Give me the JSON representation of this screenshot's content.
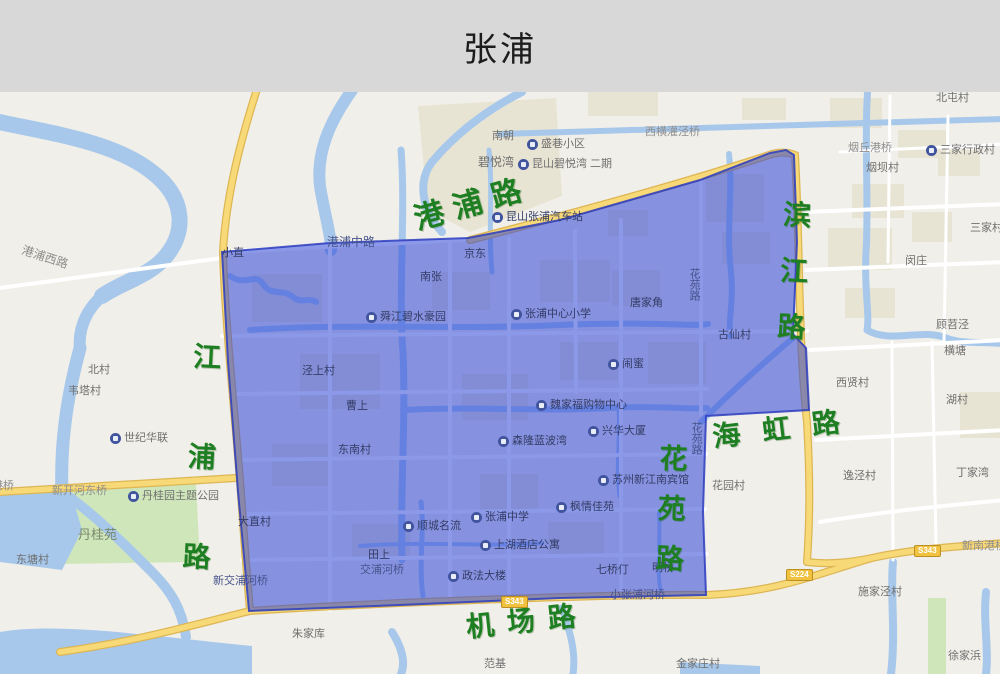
{
  "header": {
    "title": "张浦"
  },
  "map": {
    "green_roads": [
      {
        "text": "港浦路",
        "x": 408,
        "y": 104,
        "rot": -16,
        "size": 30,
        "ls": 10,
        "vertical": false
      },
      {
        "text": "滨江路",
        "x": 776,
        "y": 107,
        "rot": 3,
        "size": 28,
        "ls": 28,
        "vertical": true
      },
      {
        "text": "江浦路",
        "x": 186,
        "y": 249,
        "rot": 3,
        "size": 28,
        "ls": 72,
        "vertical": true
      },
      {
        "text": "海虹路",
        "x": 710,
        "y": 324,
        "rot": -7,
        "size": 28,
        "ls": 22,
        "vertical": false
      },
      {
        "text": "花苑路",
        "x": 652,
        "y": 351,
        "rot": 2,
        "size": 28,
        "ls": 22,
        "vertical": true
      },
      {
        "text": "机场路",
        "x": 464,
        "y": 514,
        "rot": -6,
        "size": 28,
        "ls": 13,
        "vertical": false
      }
    ],
    "shields": [
      {
        "text": "S343",
        "x": 501,
        "y": 504
      },
      {
        "text": "S224",
        "x": 786,
        "y": 477
      },
      {
        "text": "S343",
        "x": 914,
        "y": 453
      }
    ],
    "labels": [
      {
        "text": "港浦西路",
        "x": 24,
        "y": 152,
        "tone": "road",
        "rot": 18,
        "size": 12
      },
      {
        "text": "南朝",
        "x": 492,
        "y": 38,
        "tone": "out"
      },
      {
        "text": "盛巷小区",
        "x": 527,
        "y": 46,
        "tone": "out",
        "icon": true
      },
      {
        "text": "碧悦湾",
        "x": 478,
        "y": 64,
        "tone": "out",
        "size": 12
      },
      {
        "text": "昆山碧悦湾 二期",
        "x": 518,
        "y": 66,
        "tone": "out",
        "icon": true
      },
      {
        "text": "西横灌泾桥",
        "x": 645,
        "y": 34,
        "tone": "road"
      },
      {
        "text": "北屯村",
        "x": 936,
        "y": 0,
        "tone": "out"
      },
      {
        "text": "烟丘港桥",
        "x": 848,
        "y": 50,
        "tone": "road"
      },
      {
        "text": "烟坝村",
        "x": 866,
        "y": 70,
        "tone": "out"
      },
      {
        "text": "三家行政村",
        "x": 926,
        "y": 52,
        "tone": "out",
        "icon": true
      },
      {
        "text": "三家村",
        "x": 970,
        "y": 130,
        "tone": "out"
      },
      {
        "text": "闵庄",
        "x": 905,
        "y": 163,
        "tone": "out"
      },
      {
        "text": "顾苕泾",
        "x": 936,
        "y": 227,
        "tone": "out"
      },
      {
        "text": "横塘",
        "x": 944,
        "y": 253,
        "tone": "out"
      },
      {
        "text": "西贤村",
        "x": 836,
        "y": 285,
        "tone": "out"
      },
      {
        "text": "湖村",
        "x": 946,
        "y": 302,
        "tone": "out"
      },
      {
        "text": "逸泾村",
        "x": 843,
        "y": 378,
        "tone": "out"
      },
      {
        "text": "丁家湾",
        "x": 956,
        "y": 375,
        "tone": "out"
      },
      {
        "text": "新南港桥",
        "x": 962,
        "y": 448,
        "tone": "road"
      },
      {
        "text": "施家泾村",
        "x": 858,
        "y": 494,
        "tone": "out"
      },
      {
        "text": "徐家浜",
        "x": 948,
        "y": 558,
        "tone": "out"
      },
      {
        "text": "金家庄村",
        "x": 676,
        "y": 566,
        "tone": "out"
      },
      {
        "text": "范基",
        "x": 484,
        "y": 566,
        "tone": "out"
      },
      {
        "text": "朱家库",
        "x": 292,
        "y": 536,
        "tone": "out"
      },
      {
        "text": "北村",
        "x": 88,
        "y": 272,
        "tone": "out"
      },
      {
        "text": "韦塔村",
        "x": 68,
        "y": 293,
        "tone": "out"
      },
      {
        "text": "世纪华联",
        "x": 110,
        "y": 340,
        "tone": "out",
        "icon": true
      },
      {
        "text": "港桥",
        "x": -8,
        "y": 388,
        "tone": "road"
      },
      {
        "text": "新开河东桥",
        "x": 52,
        "y": 393,
        "tone": "road"
      },
      {
        "text": "丹桂园主题公园",
        "x": 128,
        "y": 398,
        "tone": "out",
        "icon": true
      },
      {
        "text": "丹桂苑",
        "x": 78,
        "y": 436,
        "tone": "park",
        "size": 13
      },
      {
        "text": "东塘村",
        "x": 16,
        "y": 462,
        "tone": "out"
      },
      {
        "text": "小直",
        "x": 222,
        "y": 155,
        "tone": "in"
      },
      {
        "text": "港浦中路",
        "x": 327,
        "y": 144,
        "tone": "roadin",
        "size": 12
      },
      {
        "text": "昆山张浦汽车站",
        "x": 492,
        "y": 119,
        "tone": "in",
        "icon": true
      },
      {
        "text": "京东",
        "x": 464,
        "y": 156,
        "tone": "in"
      },
      {
        "text": "南张",
        "x": 420,
        "y": 179,
        "tone": "in"
      },
      {
        "text": "舜江碧水豪园",
        "x": 366,
        "y": 219,
        "tone": "in",
        "icon": true
      },
      {
        "text": "张浦中心小学",
        "x": 511,
        "y": 216,
        "tone": "in",
        "icon": true
      },
      {
        "text": "唐家角",
        "x": 630,
        "y": 205,
        "tone": "in"
      },
      {
        "text": "花苑路",
        "x": 688,
        "y": 176,
        "tone": "roadin",
        "vertical": true
      },
      {
        "text": "古仙村",
        "x": 718,
        "y": 237,
        "tone": "in"
      },
      {
        "text": "闹蜜",
        "x": 608,
        "y": 266,
        "tone": "in",
        "icon": true
      },
      {
        "text": "泾上村",
        "x": 302,
        "y": 273,
        "tone": "in"
      },
      {
        "text": "曹上",
        "x": 346,
        "y": 308,
        "tone": "in"
      },
      {
        "text": "魏家福购物中心",
        "x": 536,
        "y": 307,
        "tone": "in",
        "icon": true
      },
      {
        "text": "兴华大厦",
        "x": 588,
        "y": 333,
        "tone": "in",
        "icon": true
      },
      {
        "text": "东南村",
        "x": 338,
        "y": 352,
        "tone": "in"
      },
      {
        "text": "森隆蓝波湾",
        "x": 498,
        "y": 343,
        "tone": "in",
        "icon": true
      },
      {
        "text": "花苑路",
        "x": 690,
        "y": 330,
        "tone": "roadin",
        "vertical": true
      },
      {
        "text": "苏州新江南宾馆",
        "x": 598,
        "y": 382,
        "tone": "in",
        "icon": true
      },
      {
        "text": "花园村",
        "x": 712,
        "y": 388,
        "tone": "out"
      },
      {
        "text": "枫情佳苑",
        "x": 556,
        "y": 409,
        "tone": "in",
        "icon": true
      },
      {
        "text": "张浦中学",
        "x": 471,
        "y": 419,
        "tone": "in",
        "icon": true
      },
      {
        "text": "顺城名流",
        "x": 403,
        "y": 428,
        "tone": "in",
        "icon": true
      },
      {
        "text": "上湖酒店公寓",
        "x": 480,
        "y": 447,
        "tone": "in",
        "icon": true
      },
      {
        "text": "政法大楼",
        "x": 448,
        "y": 478,
        "tone": "in",
        "icon": true
      },
      {
        "text": "七桥仃",
        "x": 596,
        "y": 472,
        "tone": "in"
      },
      {
        "text": "明桥",
        "x": 652,
        "y": 470,
        "tone": "in"
      },
      {
        "text": "小张浦河桥",
        "x": 610,
        "y": 497,
        "tone": "roadin"
      },
      {
        "text": "田上",
        "x": 368,
        "y": 457,
        "tone": "in"
      },
      {
        "text": "交浦河桥",
        "x": 360,
        "y": 472,
        "tone": "roadin"
      },
      {
        "text": "新交浦河桥",
        "x": 213,
        "y": 483,
        "tone": "roadin"
      },
      {
        "text": "大直村",
        "x": 238,
        "y": 424,
        "tone": "in"
      }
    ]
  }
}
